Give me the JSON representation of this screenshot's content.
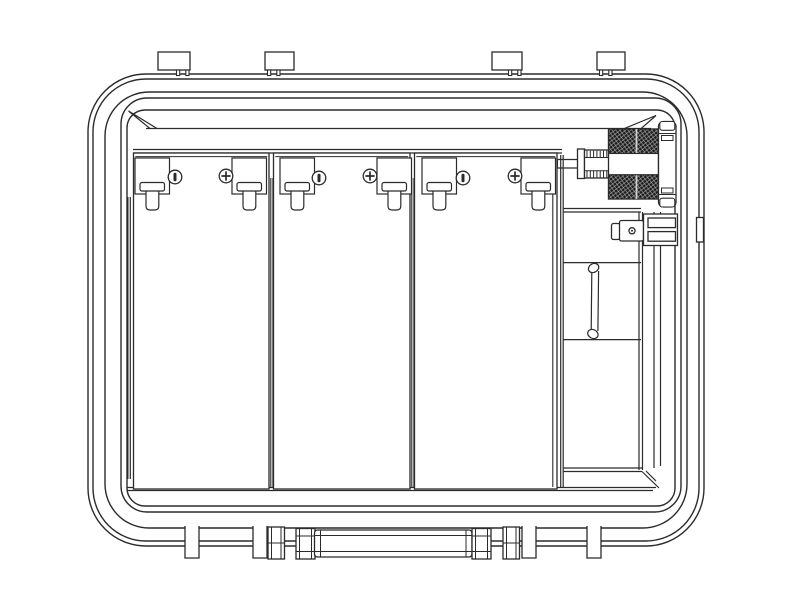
{
  "figure": {
    "type": "technical-line-drawing",
    "subject": "Open equipment case, front view: three battery modules with terminal clips and screws, knurled bulkhead knob, side connector plug with clamp bracket, vertical pull strap, lid hinge tabs on top, folded carry handle and feet on bottom",
    "components": {
      "case_shell": "rounded molded case shell with multiple wall outlines",
      "lid_tab_count": 4,
      "battery_module_count": 3,
      "terminal_clip_count": 6,
      "screw_count": 6,
      "case_foot_count": 4,
      "bulkhead_knob": "knurled-knob-icon",
      "connector_plug": "connector-plug-icon",
      "pull_strap": "pull-strap-icon",
      "folding_handle": "folding-handle-icon"
    }
  },
  "drawing": {
    "canvas": {
      "w": 792,
      "h": 612
    },
    "colors": {
      "background": "#ffffff",
      "line": "#2b2b2b",
      "knurl": "#1b1b1b",
      "knurl_highlight": "#b9b9b9"
    },
    "tab": {
      "y": 52,
      "h": 18,
      "leg_w": 3.2,
      "leg_h": 5.5
    },
    "lid_tabs": [
      {
        "x": 158,
        "w": 32,
        "notch": "right"
      },
      {
        "x": 265,
        "w": 29,
        "notch": "left"
      },
      {
        "x": 492,
        "w": 30,
        "notch": "right"
      },
      {
        "x": 597,
        "w": 28,
        "notch": "left"
      }
    ],
    "foot": {
      "y": 526,
      "h": 32,
      "w": 14
    },
    "feet": [
      185,
      253,
      522,
      587
    ],
    "panel": {
      "top": 153,
      "bottom": 489
    },
    "panels": [
      {
        "x": 133.5,
        "w": 135.5
      },
      {
        "x": 273.5,
        "w": 136.5
      },
      {
        "x": 414.5,
        "w": 142.5
      }
    ],
    "clip": {
      "y": 158,
      "w": 34.5,
      "h": 36
    },
    "clips": [
      135,
      232,
      280,
      377,
      422,
      521
    ],
    "screws": [
      {
        "x": 175,
        "y": 177,
        "type": "slotted"
      },
      {
        "x": 226,
        "y": 176,
        "type": "phillips"
      },
      {
        "x": 319,
        "y": 178,
        "type": "slotted"
      },
      {
        "x": 370,
        "y": 176,
        "type": "phillips"
      },
      {
        "x": 463,
        "y": 178,
        "type": "slotted"
      },
      {
        "x": 515,
        "y": 176,
        "type": "phillips"
      }
    ],
    "knob_threads": {
      "x0": 587,
      "x1": 607,
      "step": 3.3,
      "top": [
        150.8,
        157.5
      ],
      "bottom": [
        170.8,
        177.6
      ]
    }
  }
}
